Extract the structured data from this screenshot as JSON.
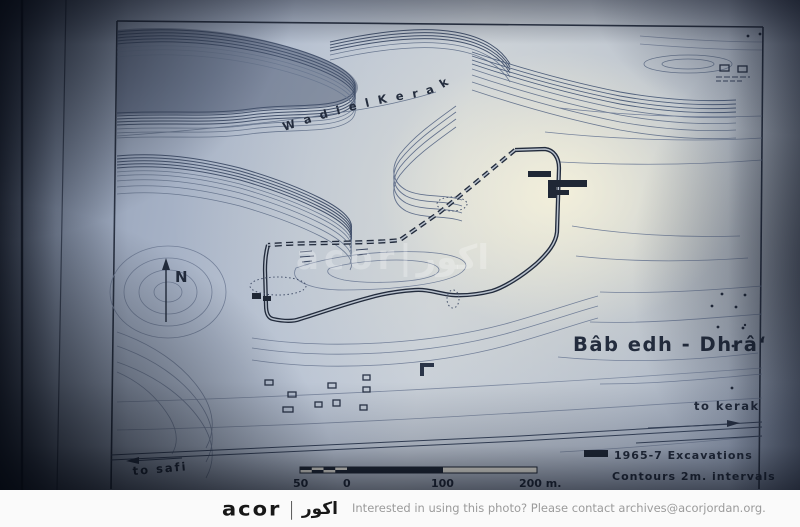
{
  "photo": {
    "map": {
      "wadi_label": "W a d i     e l     K e r a k",
      "north_label": "N",
      "site_title": "Bâb edh - Dhrâ‘",
      "road_label_right": "to kerak",
      "road_label_left": "to safi",
      "legend": {
        "excavations": "1965-7  Excavations",
        "contours": "Contours  2m.  intervals"
      },
      "scale": {
        "labels": [
          "50",
          "0",
          "100",
          "200 m."
        ]
      },
      "colors": {
        "ink": "#232c3d",
        "contour_dark": "#45536d",
        "contour_light": "#6b7991",
        "paper_bright": "#f2ecd6",
        "paper_blue": "#b6c1d3"
      }
    },
    "watermark": "acor|اكور"
  },
  "footer": {
    "logo_latin": "acor",
    "logo_divider": "|",
    "logo_arabic": "اكور",
    "caption": "Interested in using this photo? Please contact archives@acorjordan.org."
  }
}
